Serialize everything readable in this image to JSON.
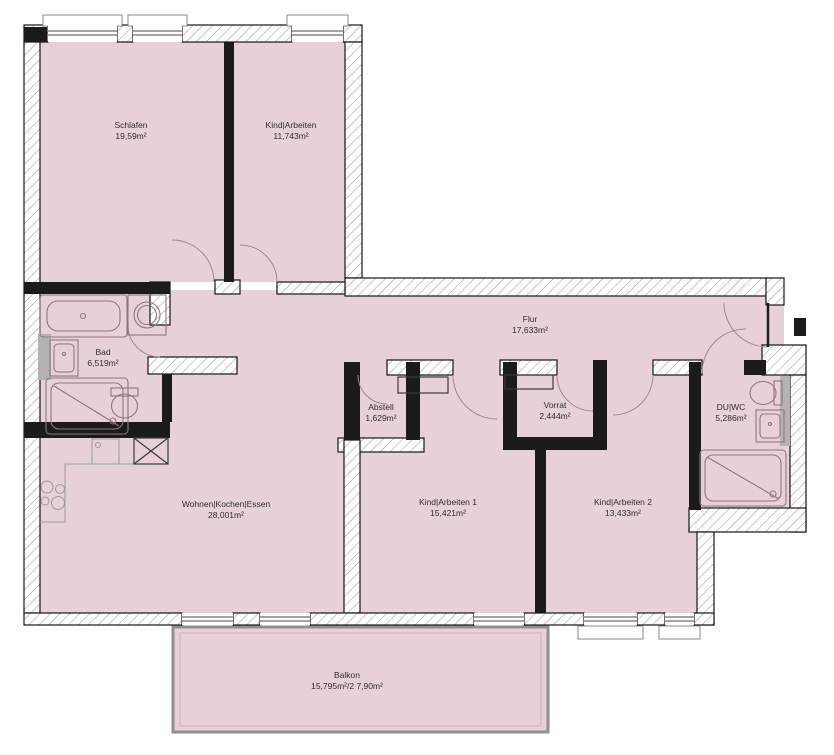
{
  "floorplan": {
    "rooms": [
      {
        "id": "schlafen",
        "name": "Schlafen",
        "area": "19,59m²"
      },
      {
        "id": "kind-arbeiten",
        "name": "Kind|Arbeiten",
        "area": "11,743m²"
      },
      {
        "id": "bad",
        "name": "Bad",
        "area": "6,519m²"
      },
      {
        "id": "flur",
        "name": "Flur",
        "area": "17,633m²"
      },
      {
        "id": "abstell",
        "name": "Abstell",
        "area": "1,629m²"
      },
      {
        "id": "vorrat",
        "name": "Vorrat",
        "area": "2,444m²"
      },
      {
        "id": "du-wc",
        "name": "DU|WC",
        "area": "5,286m²"
      },
      {
        "id": "wohnen-kochen-essen",
        "name": "Wohnen|Kochen|Essen",
        "area": "28,001m²"
      },
      {
        "id": "kind-arbeiten-1",
        "name": "Kind|Arbeiten 1",
        "area": "15,421m²"
      },
      {
        "id": "kind-arbeiten-2",
        "name": "Kind|Arbeiten 2",
        "area": "13,433m²"
      },
      {
        "id": "balkon",
        "name": "Balkon",
        "area": "15,795m²/2 7,90m²"
      }
    ],
    "colors": {
      "room_fill": "#e8d1d6",
      "wall": "#1b1b1b",
      "hatch_line": "#9b9b9b",
      "fixture_line": "#8d787d",
      "background": "#ffffff"
    }
  }
}
